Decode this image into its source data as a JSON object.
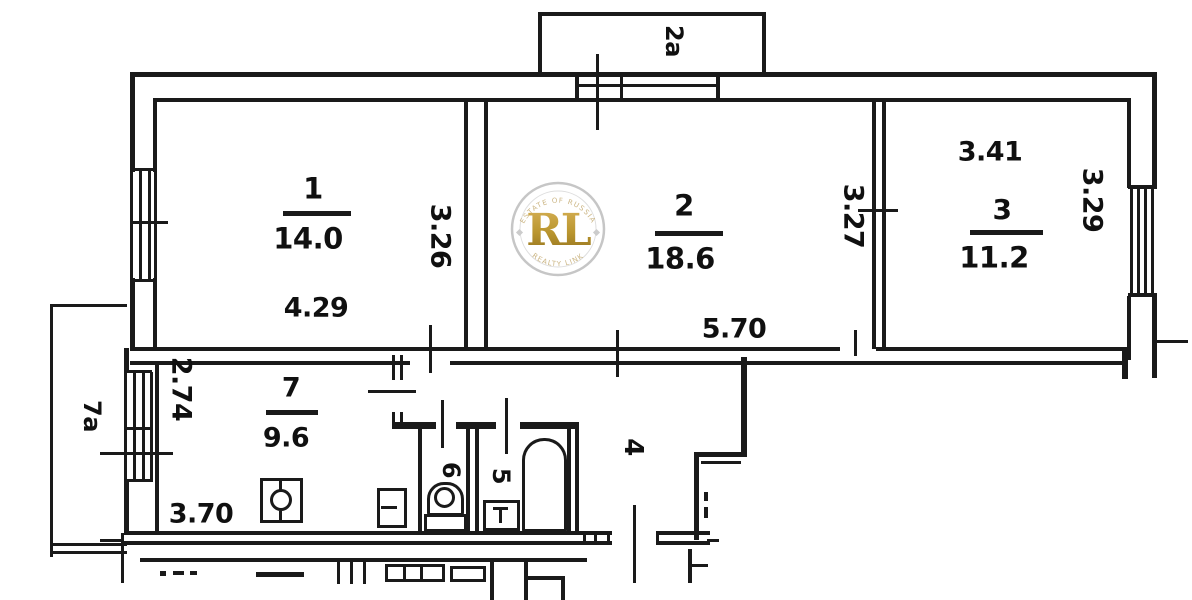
{
  "title": "Apartment floor plan",
  "rooms": {
    "r1": {
      "number": "1",
      "area": "14.0"
    },
    "r2": {
      "number": "2",
      "area": "18.6"
    },
    "r3": {
      "number": "3",
      "area": "11.2"
    },
    "r7": {
      "number": "7",
      "area": "9.6"
    }
  },
  "zones": {
    "balcony_top": "2a",
    "balcony_left": "7a",
    "hallway": "4",
    "bathroom": "5",
    "toilet": "6"
  },
  "dims": {
    "r1w": "4.29",
    "r1h": "3.26",
    "r2w": "5.70",
    "r2h": "3.27",
    "r3w": "3.41",
    "r3h": "3.29",
    "r7w": "3.70",
    "r7h": "2.74"
  },
  "watermark": {
    "monogram": "RL",
    "ring_top": "ESTATE OF RUSSIA",
    "ring_bottom": "REALTY LINK",
    "gold_color": "#b9952e",
    "ring_color": "#c6c6c6"
  }
}
